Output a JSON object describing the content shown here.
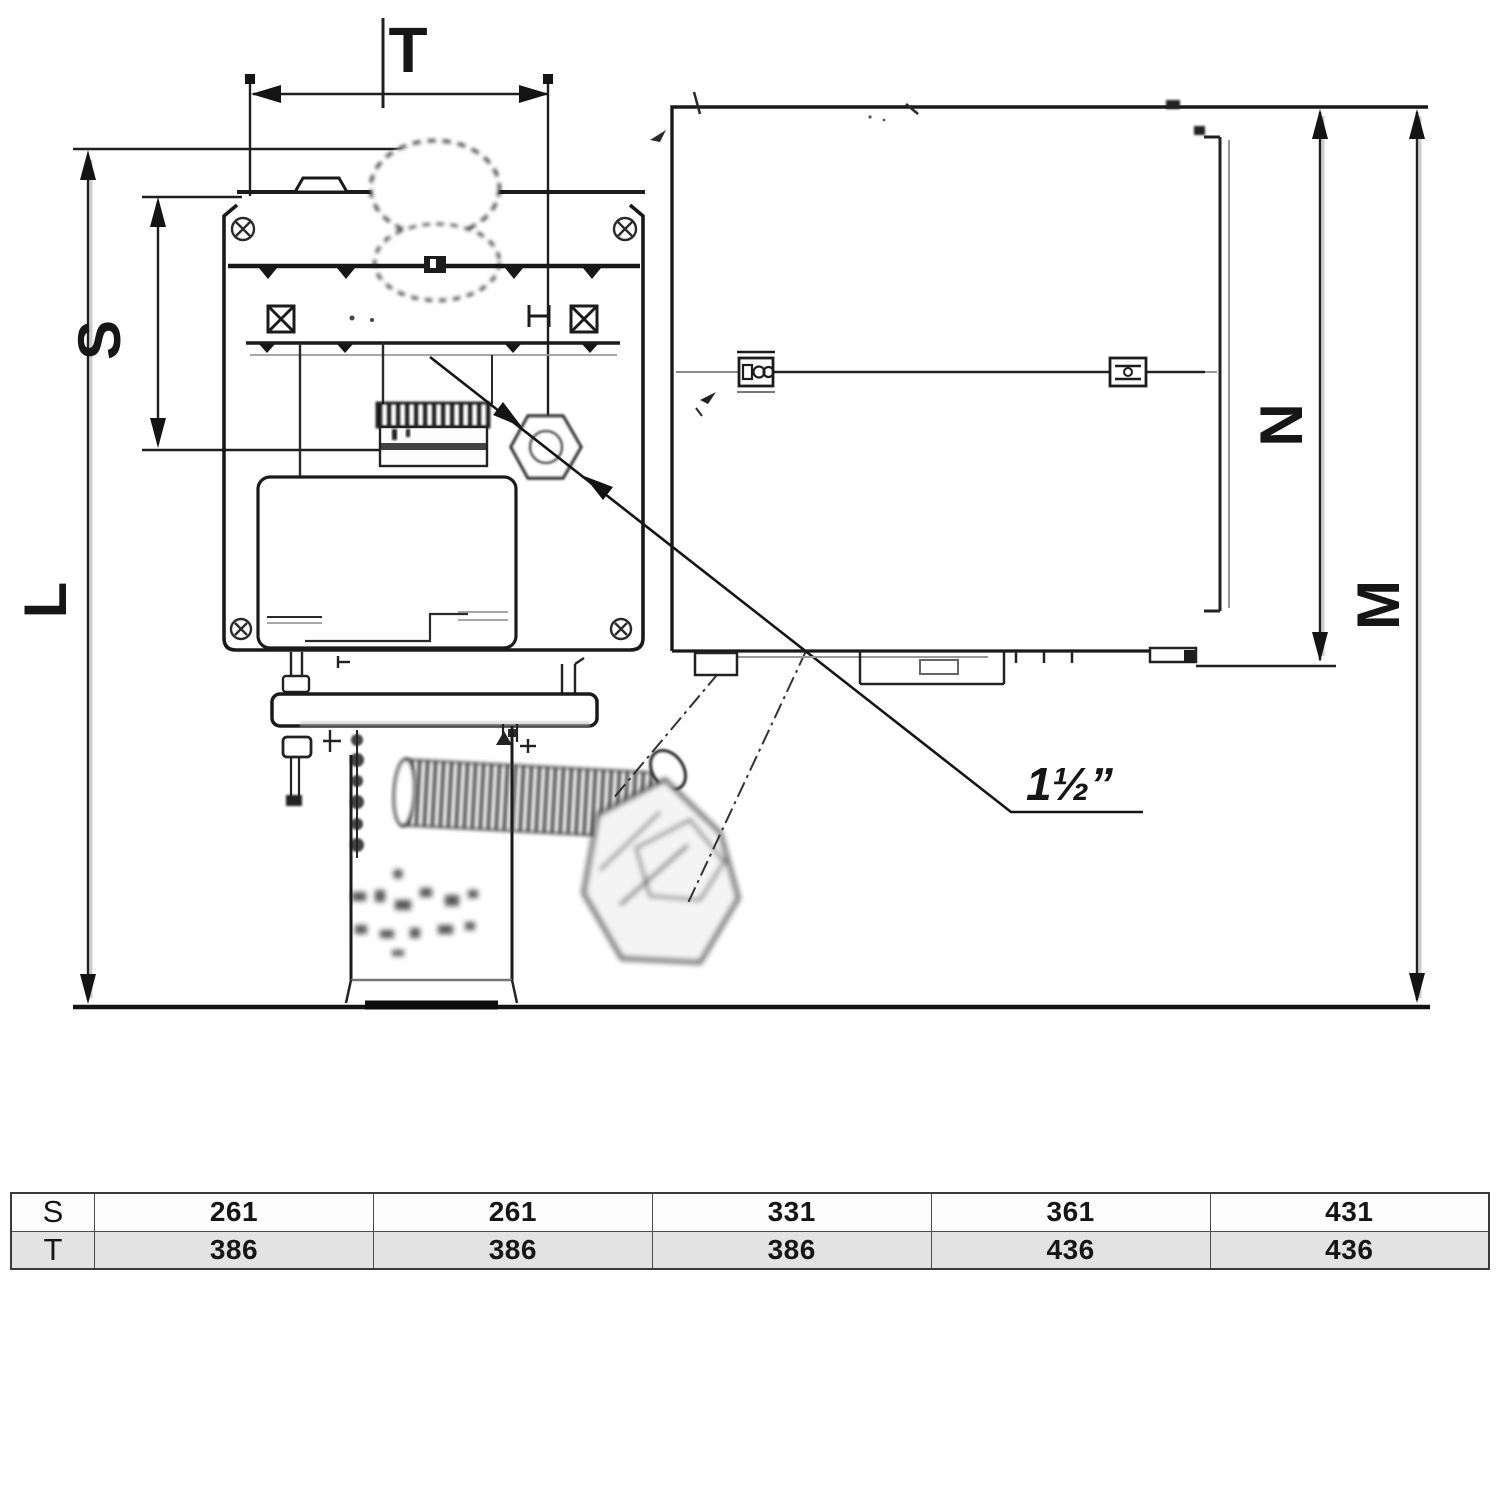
{
  "drawing": {
    "labels": {
      "T": "T",
      "S": "S",
      "L": "L",
      "N": "N",
      "M": "M"
    },
    "connection_size_label": "1½”"
  },
  "table": {
    "rows": [
      {
        "header": "S",
        "values": [
          "261",
          "261",
          "331",
          "361",
          "431"
        ]
      },
      {
        "header": "T",
        "values": [
          "386",
          "386",
          "386",
          "436",
          "436"
        ]
      }
    ]
  },
  "colors": {
    "ink": "#1a1a1a",
    "ghost": "#8a8a8a",
    "table_alt_row": "#e3e3e3",
    "table_border": "#4a4a4a"
  }
}
